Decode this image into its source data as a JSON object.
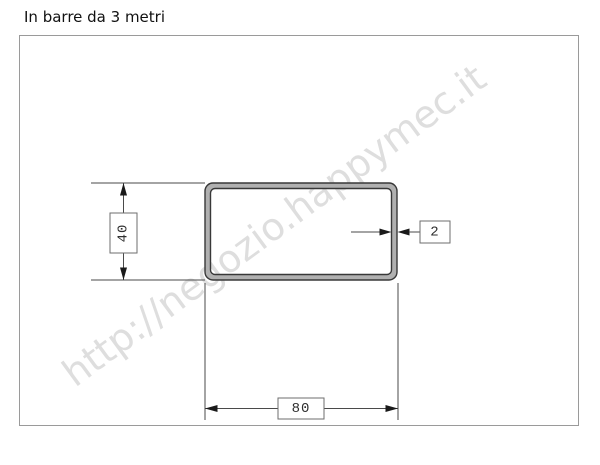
{
  "title": "In barre da 3 metri",
  "watermark": "http://negozio.happymec.it",
  "drawing": {
    "description": "Cross-section of a rectangular steel tube with dimension callouts",
    "dimensions": {
      "width": "80",
      "height": "40",
      "thickness": "2"
    }
  },
  "colors": {
    "frame_border": "#9a9a9a",
    "drawing_lines": "#4a4a4a",
    "tube_outline": "#383838",
    "tube_wall_fill": "#b0b0b0",
    "watermark": "#dedede",
    "dim_text": "#2e2e2e",
    "background": "#ffffff"
  }
}
